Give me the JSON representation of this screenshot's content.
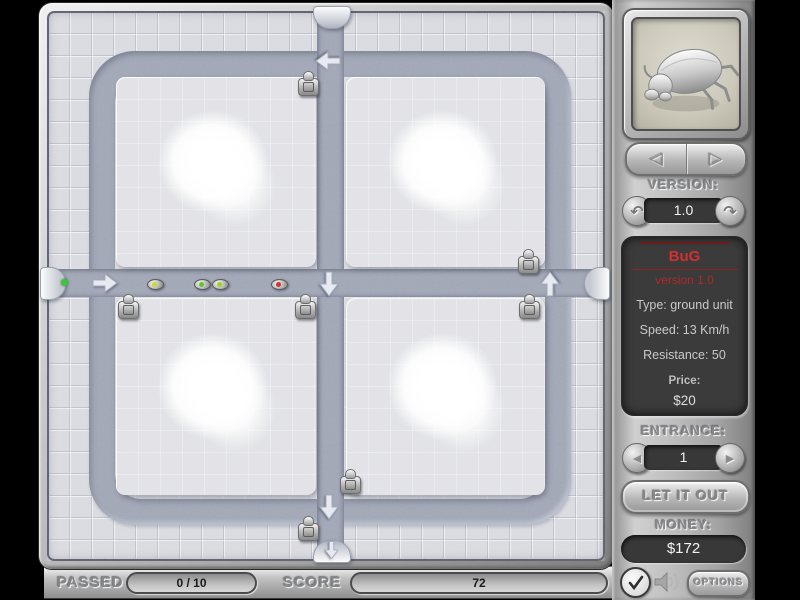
{
  "board": {
    "path_color": "#8d95a7",
    "turrets": [
      [
        261,
        72
      ],
      [
        481,
        250
      ],
      [
        81,
        295
      ],
      [
        258,
        295
      ],
      [
        482,
        295
      ],
      [
        303,
        470
      ],
      [
        261,
        517
      ]
    ],
    "bugs": [
      {
        "x": 108,
        "y": 273,
        "dot": "#c8dc28"
      },
      {
        "x": 155,
        "y": 273,
        "dot": "#62c622"
      },
      {
        "x": 173,
        "y": 273,
        "dot": "#9cd123"
      },
      {
        "x": 232,
        "y": 273,
        "dot": "#d83030"
      }
    ],
    "spawn_dot": {
      "x": 17,
      "y": 271,
      "color": "#3ec43e"
    },
    "arrows": [
      {
        "x": 281,
        "y": 50,
        "dir": "left"
      },
      {
        "x": 58,
        "y": 272,
        "dir": "right"
      },
      {
        "x": 282,
        "y": 273,
        "dir": "down"
      },
      {
        "x": 503,
        "y": 273,
        "dir": "up"
      },
      {
        "x": 282,
        "y": 496,
        "dir": "down"
      },
      {
        "x": 284,
        "y": 539,
        "dir": "down",
        "small": true
      }
    ]
  },
  "panel": {
    "nav_prev_icon": "◁",
    "nav_next_icon": "▷",
    "version_label": "VERSION:",
    "version_value": "1.0",
    "version_prev_icon": "↶",
    "version_next_icon": "↷",
    "info": {
      "title": "BuG",
      "subtitle": "version 1.0",
      "type": "Type: ground unit",
      "speed": "Speed: 13 Km/h",
      "resistance": "Resistance: 50",
      "price_label": "Price:",
      "price_value": "$20"
    },
    "entrance_label": "ENTRANCE:",
    "entrance_value": "1",
    "entrance_prev_icon": "◀",
    "entrance_next_icon": "▶",
    "let_it_out_label": "LET IT OUT",
    "money_label": "MONEY:",
    "money_value": "$172",
    "check_icon": "✓",
    "options_label": "OPTIONS"
  },
  "status_bar": {
    "passed_label": "PASSED",
    "passed_value": "0 / 10",
    "score_label": "SCORE",
    "score_value": "72"
  }
}
